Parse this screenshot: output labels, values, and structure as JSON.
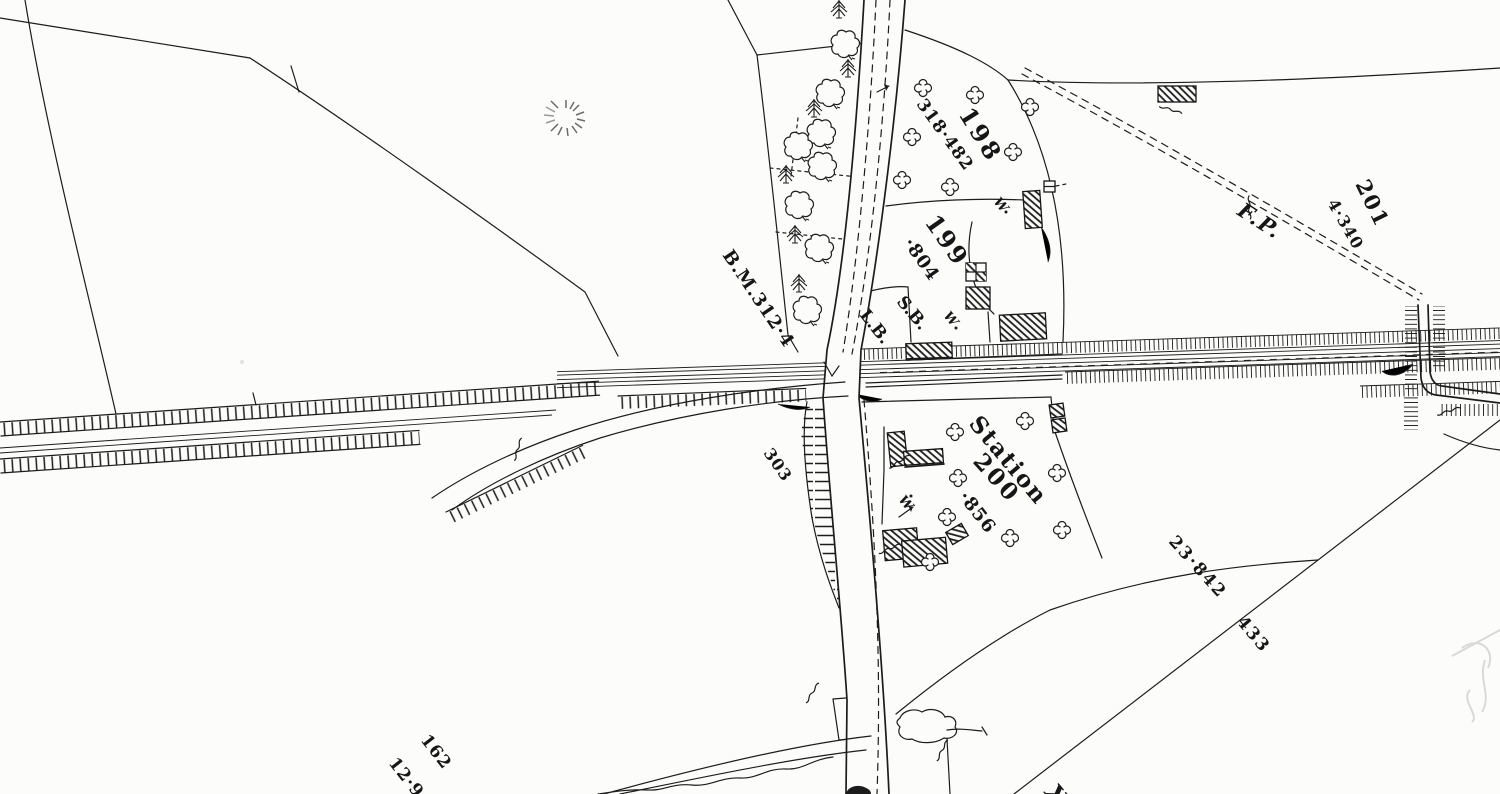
{
  "colors": {
    "paper": "#fcfcfb",
    "ink": "#1c1c1c",
    "faint_gray": "#d9d9d9"
  },
  "labels": {
    "benchmark": "B.M.312·4",
    "parcel_318_area": "318·482",
    "parcel_198": "198",
    "parcel_199": "199",
    "parcel_199_area": "·804",
    "signal_box": "S.B.",
    "letter_box": "L.B.",
    "footpath": "F.P.",
    "parcel_201": "201",
    "parcel_201_area": "4·340",
    "slope_303": "303",
    "station": "Station",
    "parcel_200": "200",
    "parcel_200_area": "·856",
    "boundary_value_23842": "23·842",
    "boundary_value_433": "433",
    "parcel_162": "162",
    "parcel_162_area": "12·9",
    "sheet_ref_partial": "X",
    "well": "W"
  }
}
